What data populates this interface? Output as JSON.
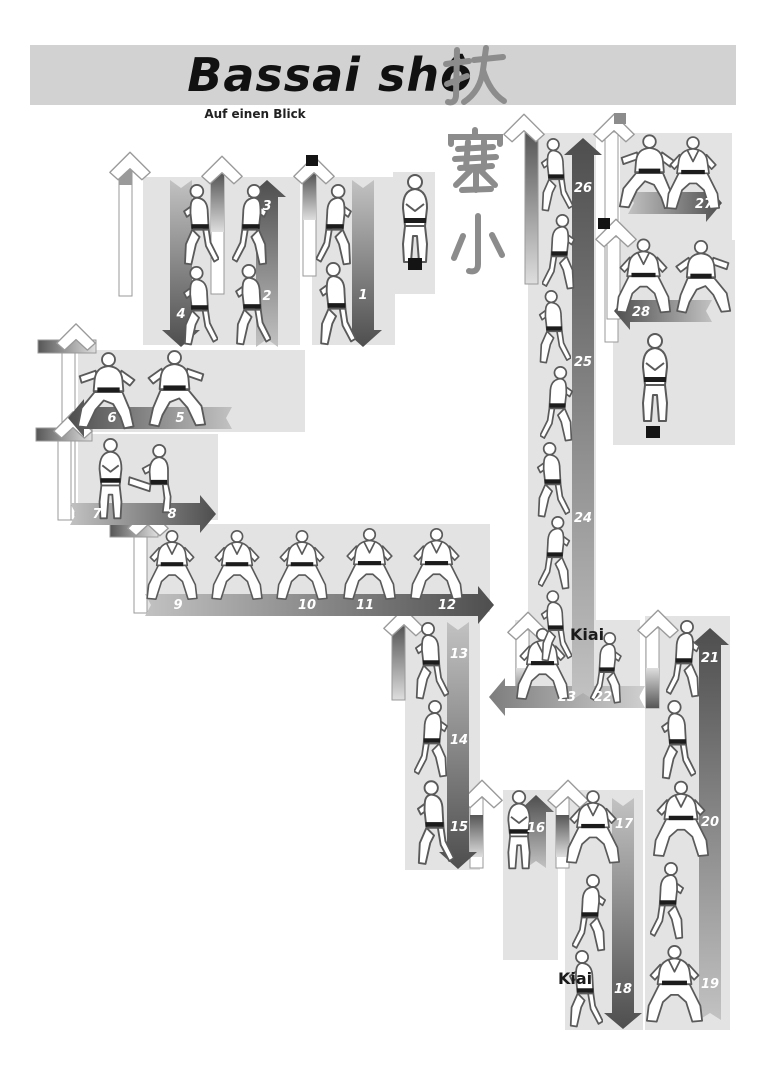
{
  "header": {
    "title": "Bassai shô",
    "subtitle": "Auf einen Blick",
    "kanji": [
      "抜",
      "塞",
      "小"
    ]
  },
  "labels": {
    "kiai": "Kiai"
  },
  "step_numbers": [
    "1",
    "2",
    "3",
    "4",
    "5",
    "6",
    "7",
    "8",
    "9",
    "10",
    "11",
    "12",
    "13",
    "14",
    "15",
    "16",
    "17",
    "18",
    "19",
    "20",
    "21",
    "22",
    "23",
    "24",
    "25",
    "26",
    "27",
    "28"
  ],
  "colors": {
    "banner": "#d2d2d2",
    "zone_block": "#e3e3e3",
    "arrow_dark": "#4e4e4e",
    "arrow_light": "#bdbdbd",
    "kanji_gray": "#8c8c8c",
    "number_text": "#ffffff",
    "start_end_square": "#141414"
  }
}
